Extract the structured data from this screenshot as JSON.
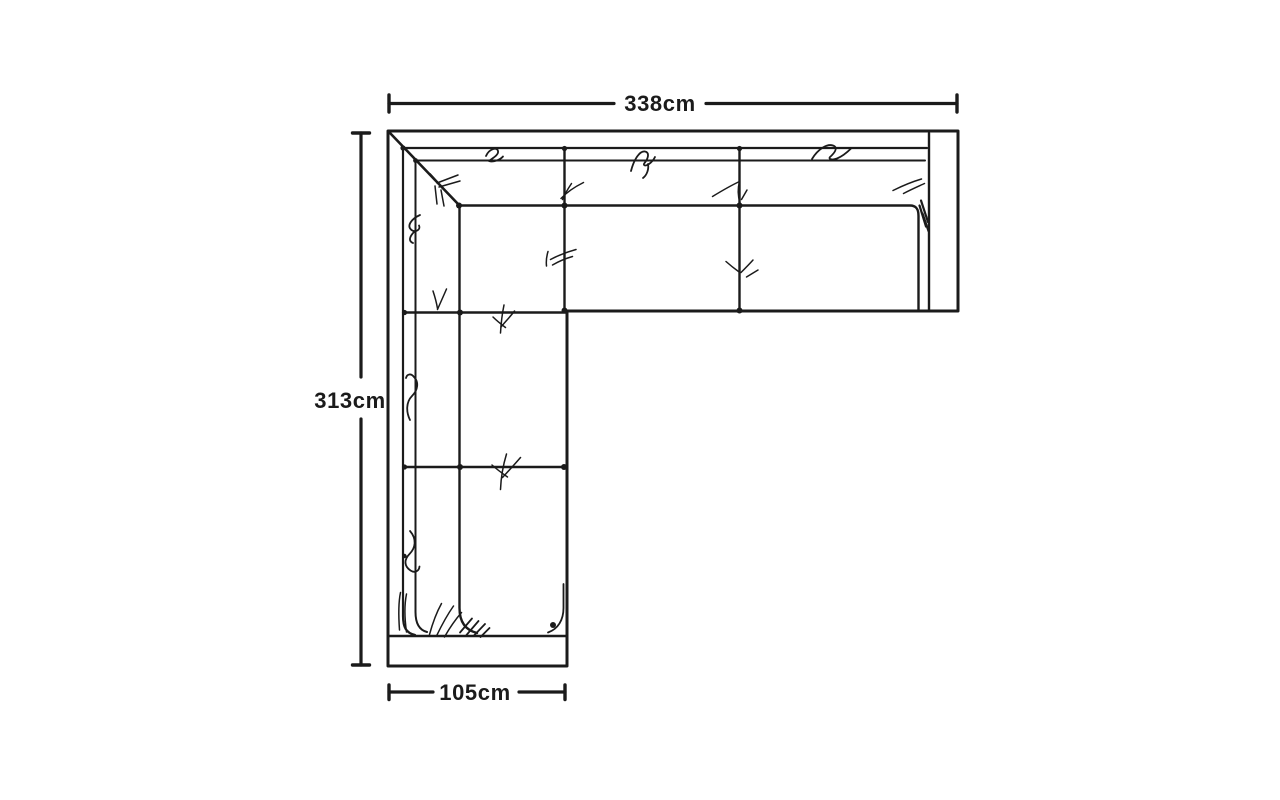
{
  "theme": {
    "ink": "#1b1b1b",
    "paper": "#ffffff"
  },
  "drawing": {
    "description": "Hand-drawn top view of an L-shaped corner sofa with overall dimensions",
    "dimensions": {
      "top": {
        "label": "338cm"
      },
      "left": {
        "label": "313cm"
      },
      "bottom": {
        "label": "105cm"
      }
    }
  }
}
